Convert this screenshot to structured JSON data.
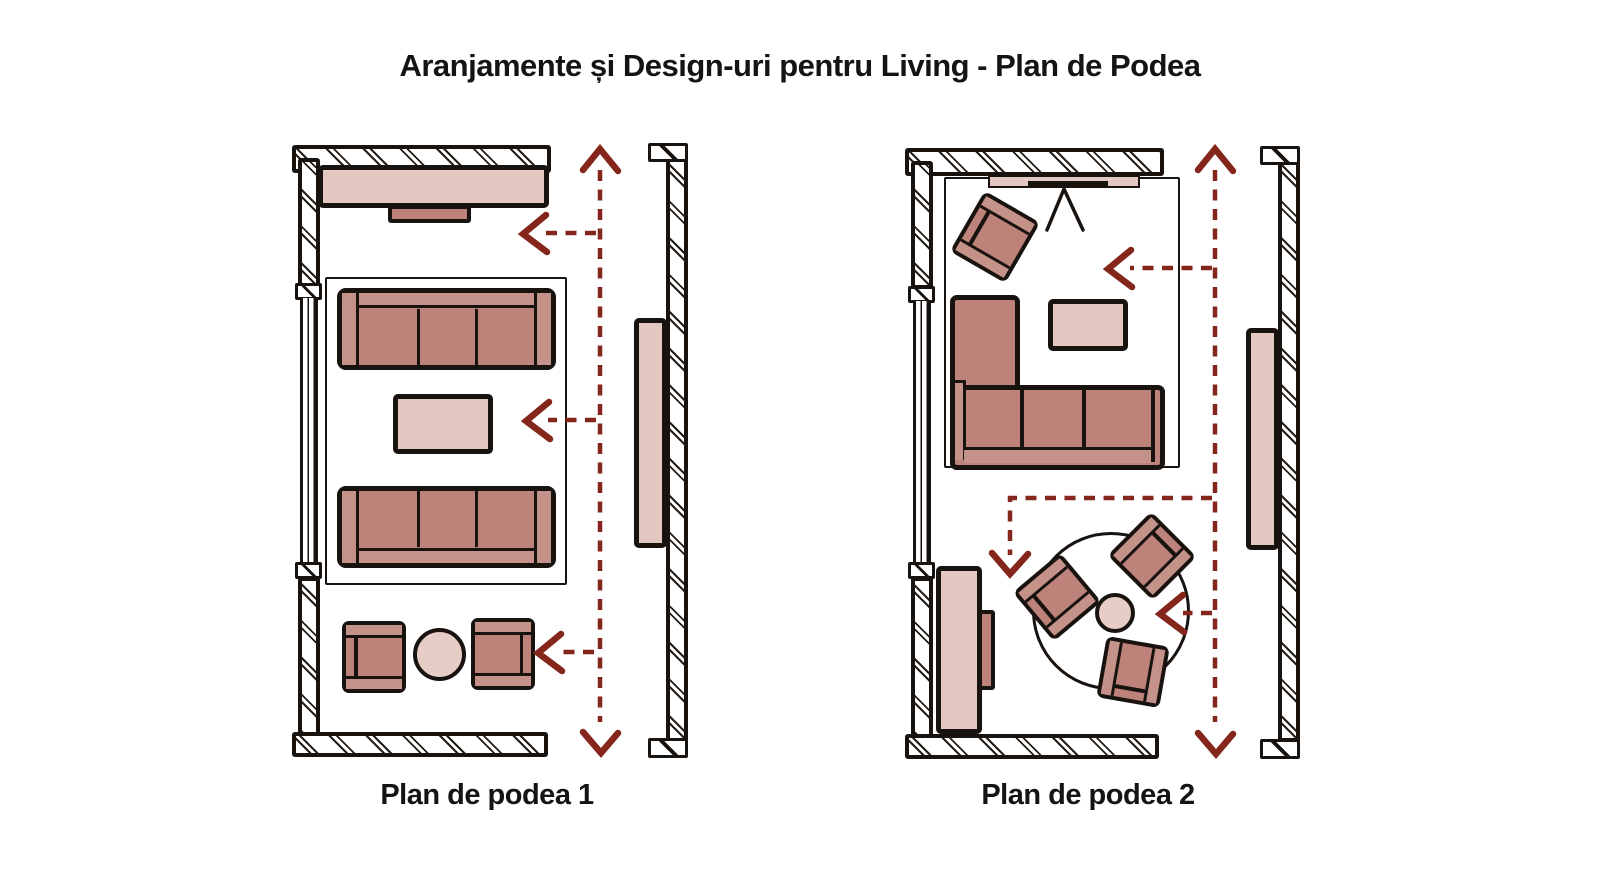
{
  "title": "Aranjamente și Design-uri pentru Living - Plan de Podea",
  "colors": {
    "outline": "#191310",
    "sofa_seat": "#bd8279",
    "sofa_band": "#c5928a",
    "light_furniture": "#e2c8c1",
    "arrow": "#84261b",
    "background": "#ffffff"
  },
  "plans": {
    "plan1": {
      "label": "Plan de podea 1",
      "architecture": [
        "hatched-wall-top",
        "hatched-wall-left-with-window",
        "hatched-wall-bottom",
        "hatched-wall-right-segment",
        "door-opening-right"
      ],
      "furniture": [
        "console-on-top-wall",
        "tv-small-unit",
        "area-rug",
        "three-seat-sofa-facing-down",
        "coffee-table",
        "three-seat-sofa-facing-up",
        "armchair-left",
        "round-side-table",
        "armchair-right",
        "sideboard-on-right-wall"
      ],
      "arrows": [
        "vertical-circulation-arrow-double-headed",
        "arrow-left-top",
        "arrow-left-middle",
        "arrow-left-bottom"
      ]
    },
    "plan2": {
      "label": "Plan de podea 2",
      "architecture": [
        "hatched-wall-top",
        "hatched-wall-left-with-window",
        "hatched-wall-bottom",
        "hatched-wall-right-segment",
        "door-opening-right"
      ],
      "furniture": [
        "tv-on-easel-stand",
        "angled-armchair-corner",
        "l-shaped-sectional-sofa",
        "coffee-table",
        "round-rug",
        "round-table-center",
        "armchair-north-east",
        "armchair-west",
        "armchair-south",
        "sideboard-left-wall",
        "sideboard-right-wall"
      ],
      "arrows": [
        "vertical-circulation-arrow-double-headed",
        "arrow-left-top",
        "l-shaped-arrow-down",
        "arrow-left-to-table"
      ]
    }
  }
}
